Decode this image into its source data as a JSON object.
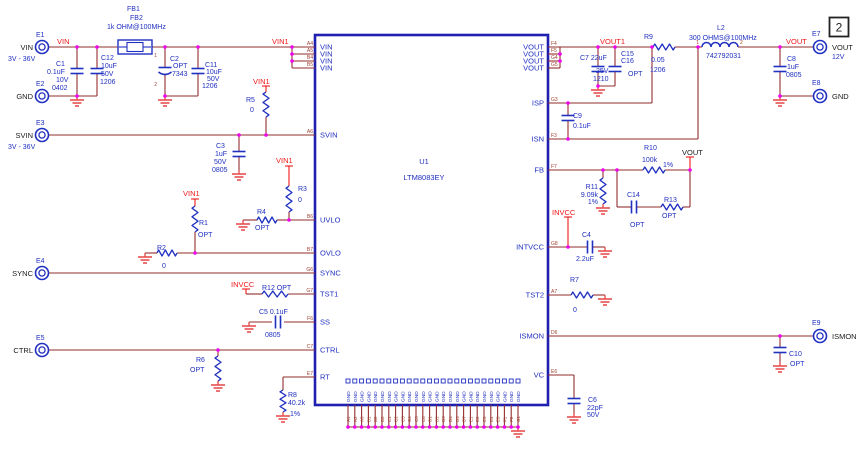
{
  "page": {
    "sheet_number": "2",
    "width": 861,
    "height": 452
  },
  "colors": {
    "wire": "#932d2d",
    "net": "#f01818",
    "symbol": "#2030c0",
    "label": "#2030c0",
    "black": "#1a1a1a",
    "pin_des": "#a04030",
    "ground": "#e85050",
    "junction": "#ee00ee",
    "ic_border": "#2020b0"
  },
  "ic": {
    "ref": "U1",
    "part_number": "LTM8083EY",
    "x": 315,
    "y": 35,
    "w": 233,
    "h": 370
  },
  "ic_pins": {
    "left": [
      {
        "des": "A4",
        "name": "VIN",
        "y": 47
      },
      {
        "des": "A5",
        "name": "VIN",
        "y": 54
      },
      {
        "des": "B4",
        "name": "VIN",
        "y": 61
      },
      {
        "des": "B5",
        "name": "VIN",
        "y": 68
      },
      {
        "des": "A6",
        "name": "SVIN",
        "y": 135
      },
      {
        "des": "B6",
        "name": "UVLO",
        "y": 220
      },
      {
        "des": "B7",
        "name": "OVLO",
        "y": 253
      },
      {
        "des": "G6",
        "name": "SYNC",
        "y": 273
      },
      {
        "des": "G7",
        "name": "TST1",
        "y": 294
      },
      {
        "des": "F6",
        "name": "SS",
        "y": 322
      },
      {
        "des": "C7",
        "name": "CTRL",
        "y": 350
      },
      {
        "des": "E7",
        "name": "RT",
        "y": 377
      }
    ],
    "right": [
      {
        "des": "F4",
        "name": "VOUT",
        "y": 47
      },
      {
        "des": "F5",
        "name": "VOUT",
        "y": 54
      },
      {
        "des": "G4",
        "name": "VOUT",
        "y": 61
      },
      {
        "des": "G5",
        "name": "VOUT",
        "y": 68
      },
      {
        "des": "G3",
        "name": "ISP",
        "y": 103
      },
      {
        "des": "F3",
        "name": "ISN",
        "y": 139
      },
      {
        "des": "F7",
        "name": "FB",
        "y": 170
      },
      {
        "des": "G8",
        "name": "INTVCC",
        "y": 247
      },
      {
        "des": "A7",
        "name": "TST2",
        "y": 295
      },
      {
        "des": "D6",
        "name": "ISMON",
        "y": 336
      },
      {
        "des": "E6",
        "name": "VC",
        "y": 375
      }
    ],
    "bottom": {
      "name": "GND",
      "count": 26,
      "x0": 348,
      "dx": 6.8,
      "y_ic_edge": 405,
      "y_rail": 427,
      "designators": [
        "A1",
        "A2",
        "A3",
        "B1",
        "B2",
        "B3",
        "C1",
        "C2",
        "C3",
        "C4",
        "C5",
        "C6",
        "D1",
        "D2",
        "D3",
        "D4",
        "D5",
        "D7",
        "E1",
        "E2",
        "E3",
        "E4",
        "E5",
        "F1",
        "F2",
        "G1"
      ]
    }
  },
  "terminals": [
    {
      "des": "E1",
      "name": "VIN",
      "sub": "3V - 36V",
      "x": 42,
      "y": 47,
      "side": "left"
    },
    {
      "des": "E2",
      "name": "GND",
      "sub": "",
      "x": 42,
      "y": 96,
      "side": "left"
    },
    {
      "des": "E3",
      "name": "SVIN",
      "sub": "3V - 36V",
      "x": 42,
      "y": 135,
      "side": "left"
    },
    {
      "des": "E4",
      "name": "SYNC",
      "sub": "",
      "x": 42,
      "y": 273,
      "side": "left"
    },
    {
      "des": "E5",
      "name": "CTRL",
      "sub": "",
      "x": 42,
      "y": 350,
      "side": "left"
    },
    {
      "des": "E7",
      "name": "VOUT",
      "sub": "12V",
      "x": 820,
      "y": 47,
      "side": "right"
    },
    {
      "des": "E8",
      "name": "GND",
      "sub": "",
      "x": 820,
      "y": 96,
      "side": "right"
    },
    {
      "des": "E9",
      "name": "ISMON",
      "sub": "",
      "x": 820,
      "y": 336,
      "side": "right"
    }
  ],
  "ferrite": {
    "ref": "FB1 / FB2",
    "x": 118,
    "y": 40,
    "w": 34,
    "h": 14
  },
  "inductor": {
    "ref": "L2",
    "x": 702,
    "y": 47,
    "w": 36,
    "loops": 4
  },
  "resistors": [
    {
      "ref": "R5",
      "o": "v",
      "x": 266,
      "y": 92,
      "l": 25
    },
    {
      "ref": "R3",
      "o": "v",
      "x": 289,
      "y": 186,
      "l": 26
    },
    {
      "ref": "R4",
      "o": "h",
      "x": 257,
      "y": 220,
      "l": 20
    },
    {
      "ref": "R1",
      "o": "v",
      "x": 195,
      "y": 206,
      "l": 26
    },
    {
      "ref": "R2",
      "o": "h",
      "x": 157,
      "y": 253,
      "l": 20
    },
    {
      "ref": "R12",
      "o": "h",
      "x": 262,
      "y": 294,
      "l": 26
    },
    {
      "ref": "R6",
      "o": "v",
      "x": 218,
      "y": 356,
      "l": 25
    },
    {
      "ref": "R8",
      "o": "v",
      "x": 283,
      "y": 390,
      "l": 22
    },
    {
      "ref": "R9",
      "o": "h",
      "x": 653,
      "y": 47,
      "l": 22
    },
    {
      "ref": "R10",
      "o": "h",
      "x": 643,
      "y": 170,
      "l": 22
    },
    {
      "ref": "R11",
      "o": "v",
      "x": 603,
      "y": 178,
      "l": 26
    },
    {
      "ref": "R13",
      "o": "h",
      "x": 661,
      "y": 207,
      "l": 22
    },
    {
      "ref": "R7",
      "o": "h",
      "x": 571,
      "y": 295,
      "l": 22
    }
  ],
  "capacitors": [
    {
      "ref": "C1",
      "o": "v",
      "x": 77,
      "y": 71
    },
    {
      "ref": "C12",
      "o": "v",
      "x": 97,
      "y": 71
    },
    {
      "ref": "C2",
      "o": "v",
      "x": 165,
      "y": 70,
      "pol": true
    },
    {
      "ref": "C11",
      "o": "v",
      "x": 198,
      "y": 71
    },
    {
      "ref": "C3",
      "o": "v",
      "x": 239,
      "y": 154
    },
    {
      "ref": "C5",
      "o": "h",
      "x": 278,
      "y": 322
    },
    {
      "ref": "C7",
      "o": "v",
      "x": 598,
      "y": 69
    },
    {
      "ref": "C15/C16",
      "o": "v",
      "x": 615,
      "y": 69
    },
    {
      "ref": "C9",
      "o": "v",
      "x": 568,
      "y": 118
    },
    {
      "ref": "C14",
      "o": "h",
      "x": 634,
      "y": 207
    },
    {
      "ref": "C4",
      "o": "h",
      "x": 590,
      "y": 247
    },
    {
      "ref": "C10",
      "o": "v",
      "x": 780,
      "y": 350
    },
    {
      "ref": "C6",
      "o": "v",
      "x": 574,
      "y": 401
    },
    {
      "ref": "C8",
      "o": "v",
      "x": 780,
      "y": 69
    }
  ],
  "grounds": [
    [
      77,
      96
    ],
    [
      165,
      96
    ],
    [
      239,
      170
    ],
    [
      243,
      220
    ],
    [
      145,
      253
    ],
    [
      249,
      322
    ],
    [
      218,
      381
    ],
    [
      283,
      412
    ],
    [
      598,
      86
    ],
    [
      603,
      204
    ],
    [
      605,
      247
    ],
    [
      605,
      295
    ],
    [
      780,
      362
    ],
    [
      574,
      413
    ],
    [
      780,
      96
    ],
    [
      518,
      427
    ]
  ],
  "wires": [
    [
      49,
      47,
      118,
      47
    ],
    [
      152,
      47,
      292,
      47
    ],
    [
      292,
      47,
      292,
      68
    ],
    [
      292,
      47,
      315,
      47
    ],
    [
      292,
      54,
      315,
      54
    ],
    [
      292,
      61,
      315,
      61
    ],
    [
      292,
      68,
      315,
      68
    ],
    [
      77,
      47,
      77,
      68
    ],
    [
      77,
      74,
      77,
      96
    ],
    [
      97,
      47,
      97,
      68
    ],
    [
      97,
      74,
      97,
      96
    ],
    [
      77,
      96,
      97,
      96
    ],
    [
      49,
      96,
      77,
      96
    ],
    [
      165,
      47,
      165,
      67
    ],
    [
      165,
      75,
      165,
      96
    ],
    [
      198,
      47,
      198,
      68
    ],
    [
      198,
      74,
      198,
      96
    ],
    [
      165,
      96,
      198,
      96
    ],
    [
      49,
      135,
      315,
      135
    ],
    [
      239,
      135,
      239,
      151
    ],
    [
      239,
      157,
      239,
      170
    ],
    [
      266,
      117,
      266,
      135
    ],
    [
      289,
      212,
      289,
      220
    ],
    [
      289,
      220,
      315,
      220
    ],
    [
      243,
      220,
      257,
      220
    ],
    [
      277,
      220,
      289,
      220
    ],
    [
      195,
      232,
      195,
      253
    ],
    [
      195,
      253,
      315,
      253
    ],
    [
      145,
      253,
      157,
      253
    ],
    [
      177,
      253,
      195,
      253
    ],
    [
      49,
      273,
      315,
      273
    ],
    [
      246,
      294,
      262,
      294
    ],
    [
      288,
      294,
      315,
      294
    ],
    [
      249,
      322,
      272,
      322
    ],
    [
      284,
      322,
      315,
      322
    ],
    [
      49,
      350,
      315,
      350
    ],
    [
      218,
      350,
      218,
      356
    ],
    [
      283,
      377,
      315,
      377
    ],
    [
      283,
      377,
      283,
      390
    ],
    [
      548,
      47,
      653,
      47
    ],
    [
      675,
      47,
      702,
      47
    ],
    [
      738,
      47,
      813,
      47
    ],
    [
      560,
      47,
      560,
      68
    ],
    [
      548,
      54,
      560,
      54
    ],
    [
      548,
      61,
      560,
      61
    ],
    [
      548,
      68,
      560,
      68
    ],
    [
      598,
      47,
      598,
      66
    ],
    [
      598,
      72,
      598,
      86
    ],
    [
      615,
      47,
      615,
      66
    ],
    [
      615,
      72,
      615,
      86
    ],
    [
      598,
      86,
      615,
      86
    ],
    [
      652,
      47,
      652,
      103
    ],
    [
      548,
      103,
      652,
      103
    ],
    [
      568,
      103,
      568,
      115
    ],
    [
      568,
      121,
      568,
      139
    ],
    [
      548,
      139,
      698,
      139
    ],
    [
      698,
      47,
      698,
      139
    ],
    [
      548,
      170,
      643,
      170
    ],
    [
      665,
      170,
      690,
      170
    ],
    [
      603,
      170,
      603,
      178
    ],
    [
      617,
      170,
      617,
      207
    ],
    [
      617,
      207,
      631,
      207
    ],
    [
      637,
      207,
      661,
      207
    ],
    [
      683,
      207,
      690,
      207
    ],
    [
      690,
      170,
      690,
      207
    ],
    [
      548,
      247,
      587,
      247
    ],
    [
      593,
      247,
      605,
      247
    ],
    [
      548,
      295,
      571,
      295
    ],
    [
      593,
      295,
      605,
      295
    ],
    [
      548,
      336,
      813,
      336
    ],
    [
      780,
      336,
      780,
      347
    ],
    [
      780,
      353,
      780,
      362
    ],
    [
      548,
      375,
      574,
      375
    ],
    [
      574,
      375,
      574,
      398
    ],
    [
      574,
      404,
      574,
      413
    ],
    [
      780,
      47,
      780,
      66
    ],
    [
      780,
      72,
      780,
      96
    ],
    [
      780,
      96,
      813,
      96
    ],
    [
      348,
      427,
      518,
      427
    ]
  ],
  "taps": [
    [
      262,
      86,
      270,
      86
    ],
    [
      266,
      86,
      266,
      92
    ],
    [
      285,
      166,
      293,
      166
    ],
    [
      289,
      166,
      289,
      186
    ],
    [
      191,
      199,
      199,
      199
    ],
    [
      195,
      199,
      195,
      206
    ],
    [
      242,
      289,
      250,
      289
    ],
    [
      246,
      289,
      246,
      294
    ],
    [
      564,
      217,
      572,
      217
    ],
    [
      568,
      217,
      568,
      247
    ],
    [
      686,
      157,
      694,
      157
    ],
    [
      690,
      157,
      690,
      170
    ]
  ],
  "junctions": [
    [
      77,
      47
    ],
    [
      97,
      47
    ],
    [
      165,
      47
    ],
    [
      198,
      47
    ],
    [
      292,
      47
    ],
    [
      292,
      54
    ],
    [
      292,
      61
    ],
    [
      239,
      135
    ],
    [
      266,
      135
    ],
    [
      289,
      220
    ],
    [
      195,
      253
    ],
    [
      218,
      350
    ],
    [
      560,
      54
    ],
    [
      560,
      61
    ],
    [
      598,
      47
    ],
    [
      615,
      47
    ],
    [
      652,
      47
    ],
    [
      698,
      47
    ],
    [
      780,
      47
    ],
    [
      568,
      103
    ],
    [
      568,
      139
    ],
    [
      603,
      170
    ],
    [
      617,
      170
    ],
    [
      690,
      170
    ],
    [
      568,
      247
    ],
    [
      780,
      336
    ],
    [
      780,
      96
    ],
    [
      77,
      96
    ],
    [
      165,
      96
    ],
    [
      598,
      86
    ]
  ],
  "labels": [
    {
      "t": "VIN",
      "x": 57,
      "y": 44,
      "c": "net"
    },
    {
      "t": "VIN1",
      "x": 272,
      "y": 44,
      "c": "net"
    },
    {
      "t": "VOUT1",
      "x": 600,
      "y": 44,
      "c": "net"
    },
    {
      "t": "VOUT",
      "x": 786,
      "y": 44,
      "c": "net"
    },
    {
      "t": "VIN1",
      "x": 253,
      "y": 84,
      "c": "net"
    },
    {
      "t": "VIN1",
      "x": 276,
      "y": 163,
      "c": "net"
    },
    {
      "t": "VIN1",
      "x": 183,
      "y": 196,
      "c": "net"
    },
    {
      "t": "INVCC",
      "x": 231,
      "y": 287,
      "c": "net"
    },
    {
      "t": "INVCC",
      "x": 552,
      "y": 215,
      "c": "net"
    },
    {
      "t": "VOUT",
      "x": 682,
      "y": 155,
      "c": "blk"
    },
    {
      "t": "FB1",
      "x": 127,
      "y": 11
    },
    {
      "t": "FB2",
      "x": 130,
      "y": 20
    },
    {
      "t": "1k OHM@100MHz",
      "x": 107,
      "y": 29
    },
    {
      "t": "C1",
      "x": 56,
      "y": 66
    },
    {
      "t": "0.1uF",
      "x": 47,
      "y": 74
    },
    {
      "t": "10V",
      "x": 56,
      "y": 82
    },
    {
      "t": "0402",
      "x": 52,
      "y": 90
    },
    {
      "t": "C12",
      "x": 101,
      "y": 60
    },
    {
      "t": "10uF",
      "x": 101,
      "y": 68
    },
    {
      "t": "50V",
      "x": 101,
      "y": 76
    },
    {
      "t": "1206",
      "x": 100,
      "y": 84
    },
    {
      "t": "C2",
      "x": 170,
      "y": 61
    },
    {
      "t": "OPT",
      "x": 173,
      "y": 68
    },
    {
      "t": "7343",
      "x": 172,
      "y": 76
    },
    {
      "t": "1",
      "x": 157,
      "y": 57,
      "c": "pd",
      "a": "end"
    },
    {
      "t": "2",
      "x": 157,
      "y": 86,
      "c": "pd",
      "a": "end"
    },
    {
      "t": "C11",
      "x": 205,
      "y": 67
    },
    {
      "t": "10uF",
      "x": 206,
      "y": 74
    },
    {
      "t": "50V",
      "x": 207,
      "y": 81
    },
    {
      "t": "1206",
      "x": 202,
      "y": 88
    },
    {
      "t": "C3",
      "x": 216,
      "y": 148
    },
    {
      "t": "1uF",
      "x": 215,
      "y": 156
    },
    {
      "t": "50V",
      "x": 214,
      "y": 164
    },
    {
      "t": "0805",
      "x": 212,
      "y": 172
    },
    {
      "t": "R5",
      "x": 246,
      "y": 102
    },
    {
      "t": "0",
      "x": 250,
      "y": 112
    },
    {
      "t": "R3",
      "x": 298,
      "y": 191
    },
    {
      "t": "0",
      "x": 298,
      "y": 202
    },
    {
      "t": "R4",
      "x": 257,
      "y": 214
    },
    {
      "t": "OPT",
      "x": 255,
      "y": 230
    },
    {
      "t": "R1",
      "x": 199,
      "y": 225
    },
    {
      "t": "OPT",
      "x": 198,
      "y": 237
    },
    {
      "t": "R2",
      "x": 157,
      "y": 250
    },
    {
      "t": "0",
      "x": 162,
      "y": 268
    },
    {
      "t": "R12 OPT",
      "x": 262,
      "y": 290
    },
    {
      "t": "C5 0.1uF",
      "x": 259,
      "y": 314
    },
    {
      "t": "0805",
      "x": 265,
      "y": 337
    },
    {
      "t": "R6",
      "x": 196,
      "y": 362
    },
    {
      "t": "OPT",
      "x": 190,
      "y": 372
    },
    {
      "t": "R8",
      "x": 288,
      "y": 397
    },
    {
      "t": "40.2k",
      "x": 288,
      "y": 405
    },
    {
      "t": "1%",
      "x": 290,
      "y": 416
    },
    {
      "t": "C7 22uF",
      "x": 580,
      "y": 60
    },
    {
      "t": "25V",
      "x": 596,
      "y": 73
    },
    {
      "t": "1210",
      "x": 593,
      "y": 81
    },
    {
      "t": "C15",
      "x": 621,
      "y": 56
    },
    {
      "t": "C16",
      "x": 621,
      "y": 63
    },
    {
      "t": "OPT",
      "x": 628,
      "y": 76
    },
    {
      "t": "R9",
      "x": 644,
      "y": 39
    },
    {
      "t": "0.05",
      "x": 651,
      "y": 62
    },
    {
      "t": "1206",
      "x": 650,
      "y": 72
    },
    {
      "t": "L2",
      "x": 717,
      "y": 30
    },
    {
      "t": "300 OHMS@100MHz",
      "x": 689,
      "y": 40
    },
    {
      "t": "742792031",
      "x": 706,
      "y": 58
    },
    {
      "t": "1",
      "x": 699,
      "y": 44,
      "c": "pd",
      "a": "end"
    },
    {
      "t": "2",
      "x": 740,
      "y": 44,
      "c": "pd"
    },
    {
      "t": "C8",
      "x": 787,
      "y": 61
    },
    {
      "t": "1uF",
      "x": 787,
      "y": 69
    },
    {
      "t": "0805",
      "x": 786,
      "y": 77
    },
    {
      "t": "C9",
      "x": 573,
      "y": 118
    },
    {
      "t": "0.1uF",
      "x": 573,
      "y": 128
    },
    {
      "t": "R10",
      "x": 644,
      "y": 150
    },
    {
      "t": "100k",
      "x": 642,
      "y": 162
    },
    {
      "t": "1%",
      "x": 663,
      "y": 167
    },
    {
      "t": "R11",
      "x": 598,
      "y": 189,
      "a": "end"
    },
    {
      "t": "9.09k",
      "x": 598,
      "y": 197,
      "a": "end"
    },
    {
      "t": "1%",
      "x": 598,
      "y": 204,
      "a": "end"
    },
    {
      "t": "C14",
      "x": 627,
      "y": 197
    },
    {
      "t": "OPT",
      "x": 630,
      "y": 227
    },
    {
      "t": "R13",
      "x": 664,
      "y": 202
    },
    {
      "t": "OPT",
      "x": 662,
      "y": 218
    },
    {
      "t": "C4",
      "x": 582,
      "y": 237
    },
    {
      "t": "2.2uF",
      "x": 576,
      "y": 261
    },
    {
      "t": "R7",
      "x": 570,
      "y": 282
    },
    {
      "t": "0",
      "x": 573,
      "y": 312
    },
    {
      "t": "C10",
      "x": 789,
      "y": 356
    },
    {
      "t": "OPT",
      "x": 790,
      "y": 366
    },
    {
      "t": "C6",
      "x": 588,
      "y": 402
    },
    {
      "t": "22pF",
      "x": 587,
      "y": 410
    },
    {
      "t": "50V",
      "x": 587,
      "y": 417
    }
  ]
}
